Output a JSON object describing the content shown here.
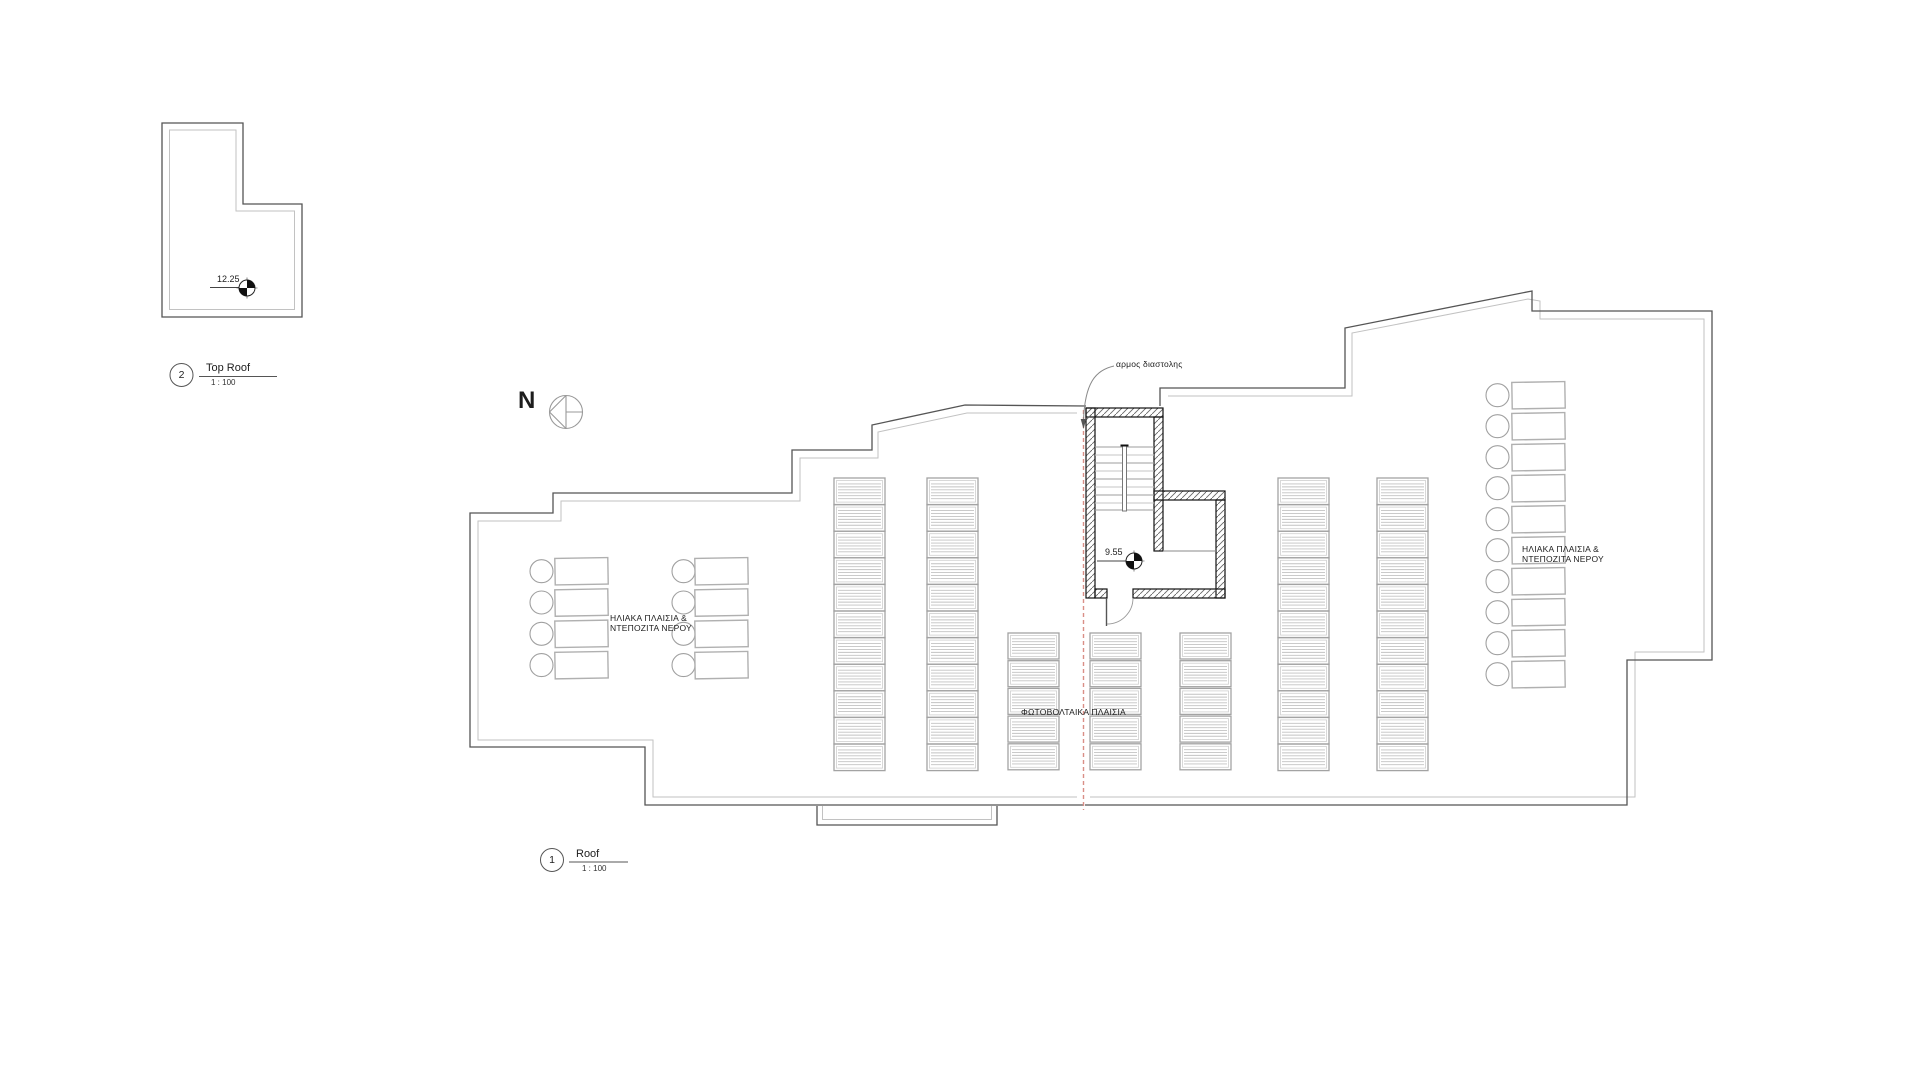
{
  "drawing": {
    "views": {
      "top_roof": {
        "number": "2",
        "title": "Top Roof",
        "scale": "1 : 100",
        "spot_elevation": "12.25"
      },
      "roof": {
        "number": "1",
        "title": "Roof",
        "scale": "1 : 100",
        "spot_elevation": "9.55"
      }
    },
    "annotations": {
      "north_letter": "N",
      "expansion_joint": "αρμος διαστολης",
      "solar_left_line1": "ΗΛΙΑΚΑ ΠΛΑΙΣΙΑ &",
      "solar_left_line2": "ΝΤΕΠΟΖΙΤΑ ΝΕΡΟΥ",
      "solar_right_line1": "ΗΛΙΑΚΑ ΠΛΑΙΣΙΑ &",
      "solar_right_line2": "ΝΤΕΠΟΖΙΤΑ ΝΕΡΟΥ",
      "photovoltaic": "ΦΩΤΟΒΟΛΤΑΙΚΑ ΠΛΑΙΣΙΑ"
    },
    "equipment": {
      "pv_panel_strips": [
        {
          "x": 834,
          "y": 478,
          "units": 11,
          "tall": true
        },
        {
          "x": 927,
          "y": 478,
          "units": 11,
          "tall": true
        },
        {
          "x": 1278,
          "y": 478,
          "units": 11,
          "tall": true
        },
        {
          "x": 1377,
          "y": 478,
          "units": 11,
          "tall": true
        },
        {
          "x": 1008,
          "y": 633,
          "units": 5,
          "tall": false
        },
        {
          "x": 1090,
          "y": 633,
          "units": 5,
          "tall": false
        },
        {
          "x": 1180,
          "y": 633,
          "units": 5,
          "tall": false
        }
      ],
      "solar_units_left": {
        "rows": 4,
        "top": 558,
        "pitch": 31.3,
        "columns": [
          {
            "circle_x": 541.5,
            "rect_x": 555
          },
          {
            "circle_x": 683.5,
            "rect_x": 695
          }
        ]
      },
      "solar_units_right": {
        "rows": 10,
        "top": 382,
        "pitch": 31,
        "columns": [
          {
            "circle_x": 1497.5,
            "rect_x": 1512
          }
        ]
      }
    },
    "colors": {
      "line_dark": "#555555",
      "line_light": "#c2c2c2",
      "panel_frame": "#a3a3a3",
      "panel_lines": "#c2c2c2",
      "tank_circle": "#a0a0a0",
      "wall_black": "#111111",
      "joint_red": "#d98f87",
      "tread_gray": "#9e9e9e"
    }
  }
}
